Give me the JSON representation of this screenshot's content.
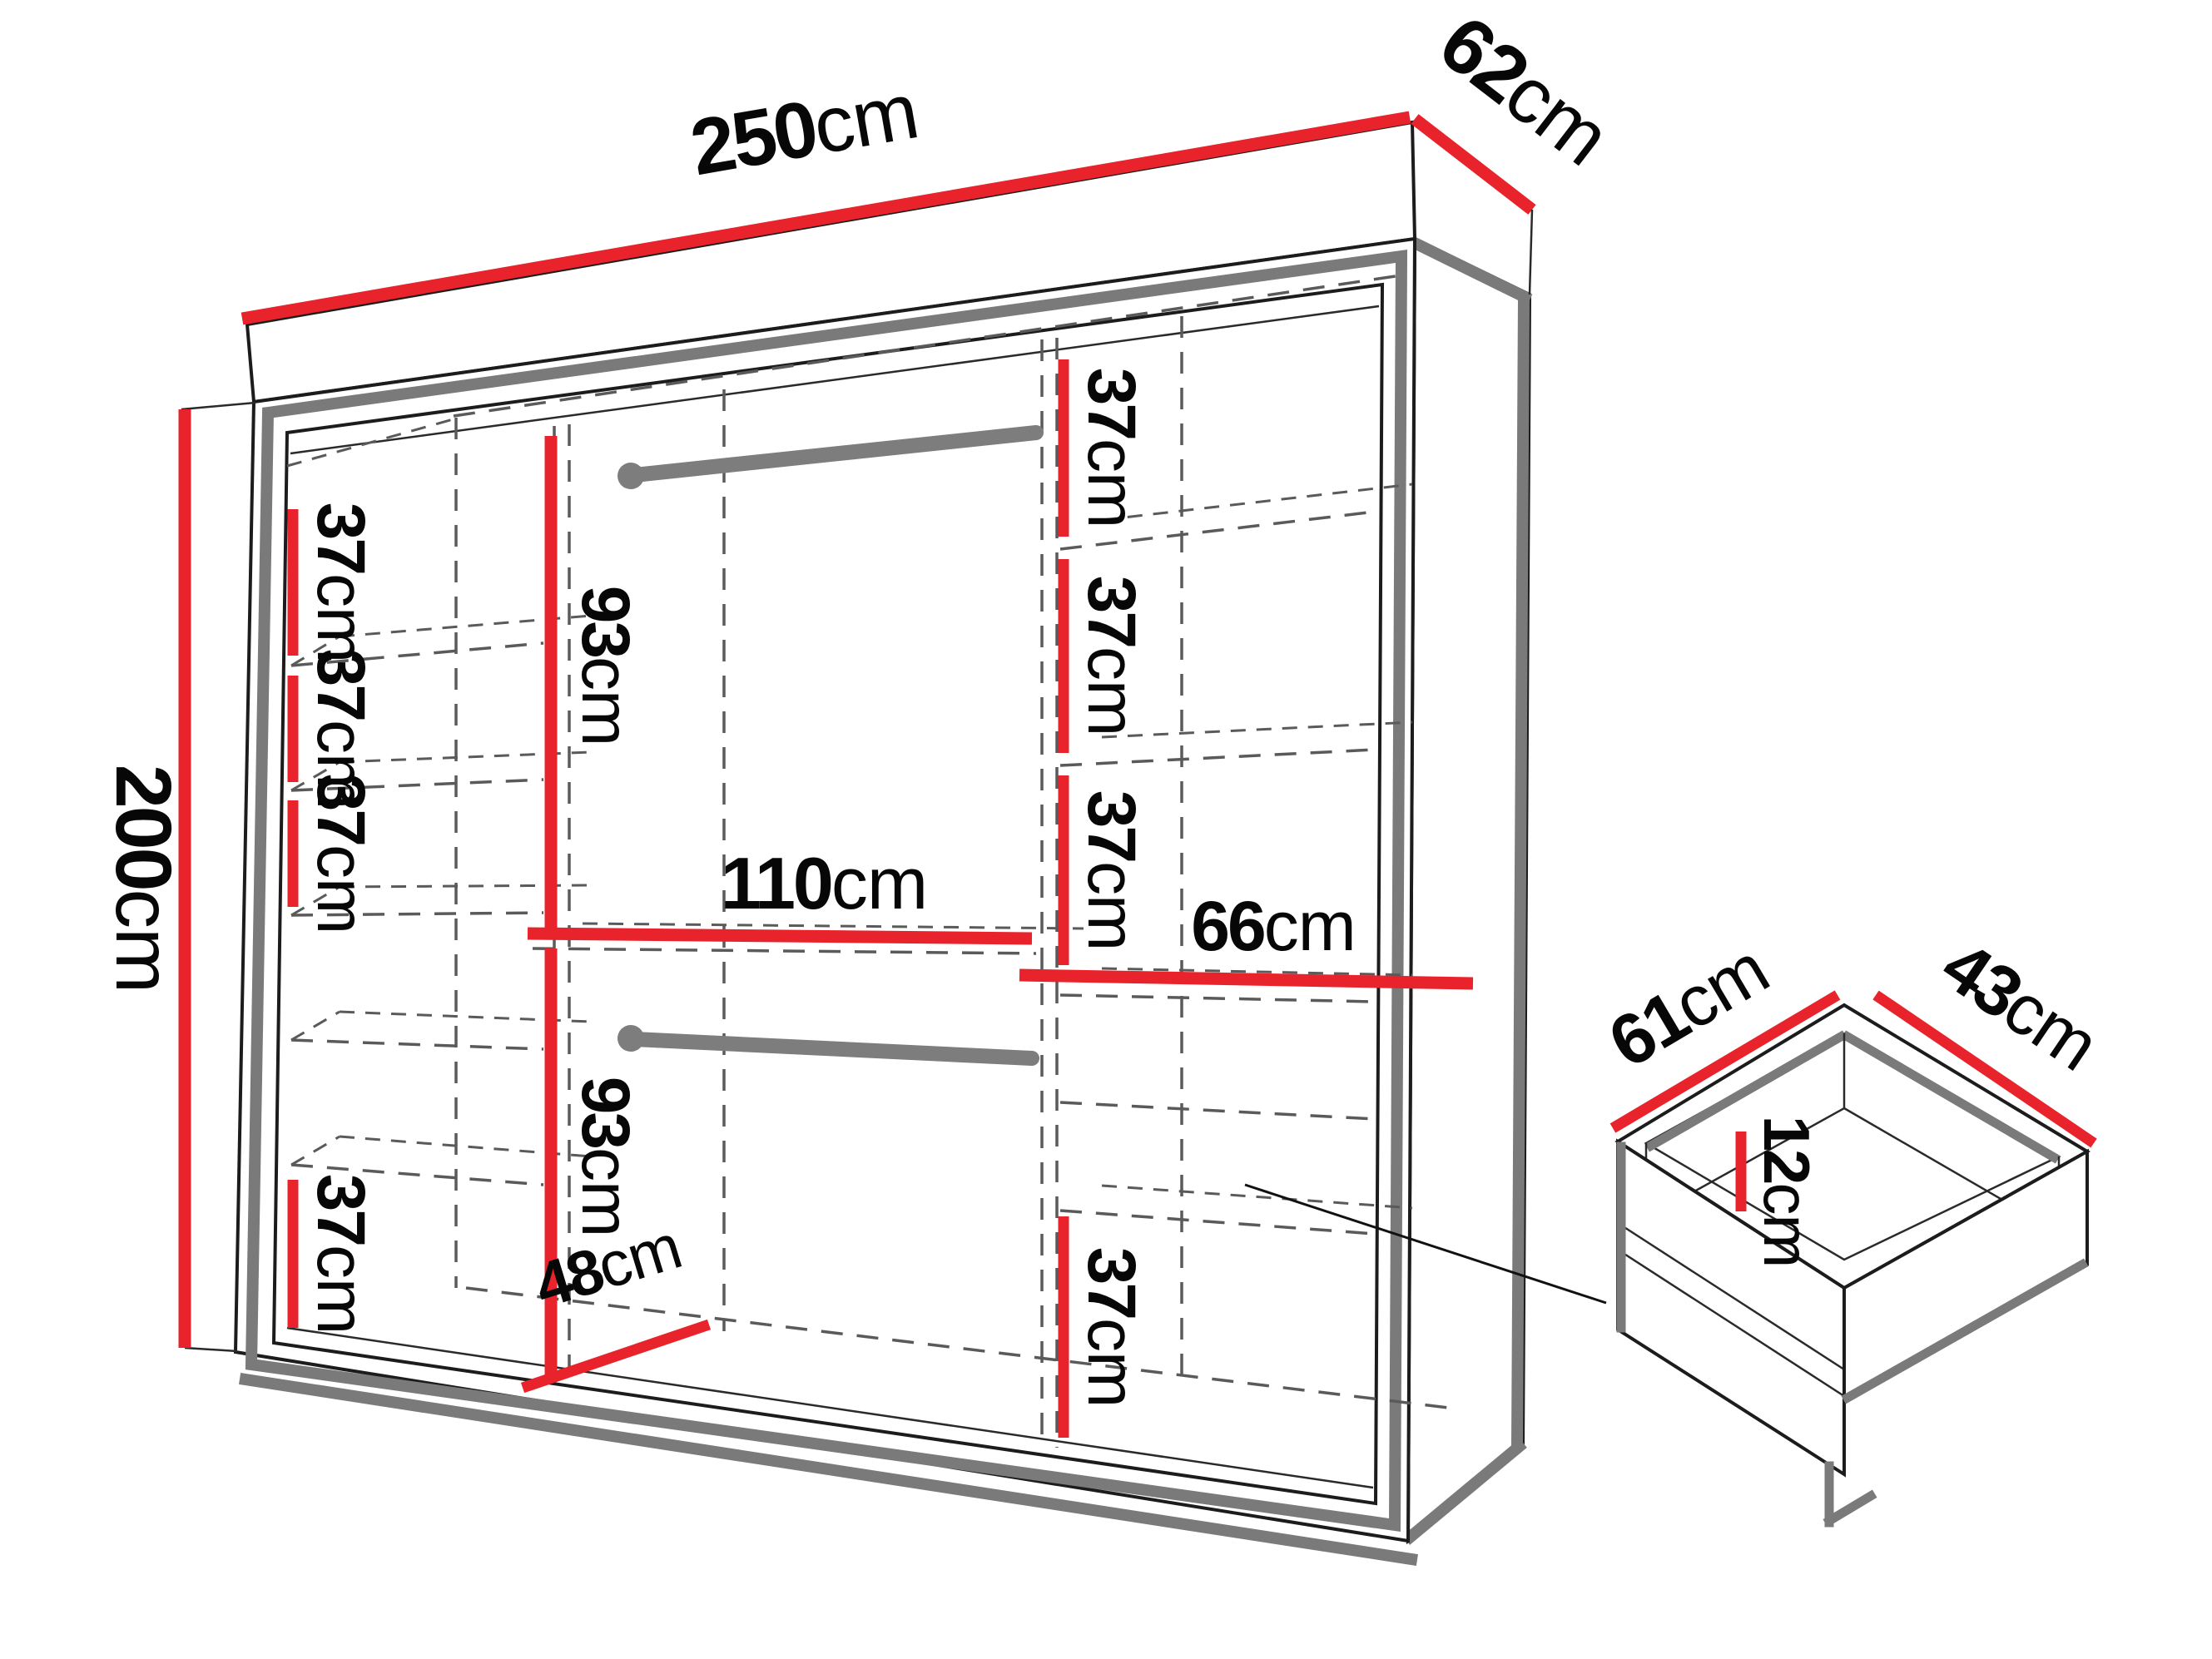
{
  "diagram": {
    "type": "wardrobe-dimension-diagram",
    "colors": {
      "dimension_line": "#e8232b",
      "frame_gray": "#7a7a7a",
      "outline_black": "#1c1c1c",
      "dashed_gray": "#5a5a5a"
    },
    "wardrobe": {
      "width": {
        "v": "250",
        "u": "cm"
      },
      "depth": {
        "v": "62",
        "u": "cm"
      },
      "height": {
        "v": "200",
        "u": "cm"
      },
      "left_shelves": [
        {
          "v": "37",
          "u": "cm"
        },
        {
          "v": "37",
          "u": "cm"
        },
        {
          "v": "37",
          "u": "cm"
        },
        {
          "v": "37",
          "u": "cm"
        }
      ],
      "middle": {
        "upper_section_height": {
          "v": "93",
          "u": "cm"
        },
        "lower_section_height": {
          "v": "93",
          "u": "cm"
        },
        "section_width": {
          "v": "110",
          "u": "cm"
        },
        "bottom_depth": {
          "v": "48",
          "u": "cm"
        }
      },
      "right_shelves": [
        {
          "v": "37",
          "u": "cm"
        },
        {
          "v": "37",
          "u": "cm"
        },
        {
          "v": "37",
          "u": "cm"
        }
      ],
      "right_shelf_width": {
        "v": "66",
        "u": "cm"
      },
      "right_bottom_shelf": {
        "v": "37",
        "u": "cm"
      }
    },
    "drawer": {
      "width": {
        "v": "61",
        "u": "cm"
      },
      "depth": {
        "v": "43",
        "u": "cm"
      },
      "height": {
        "v": "12",
        "u": "cm"
      }
    }
  }
}
